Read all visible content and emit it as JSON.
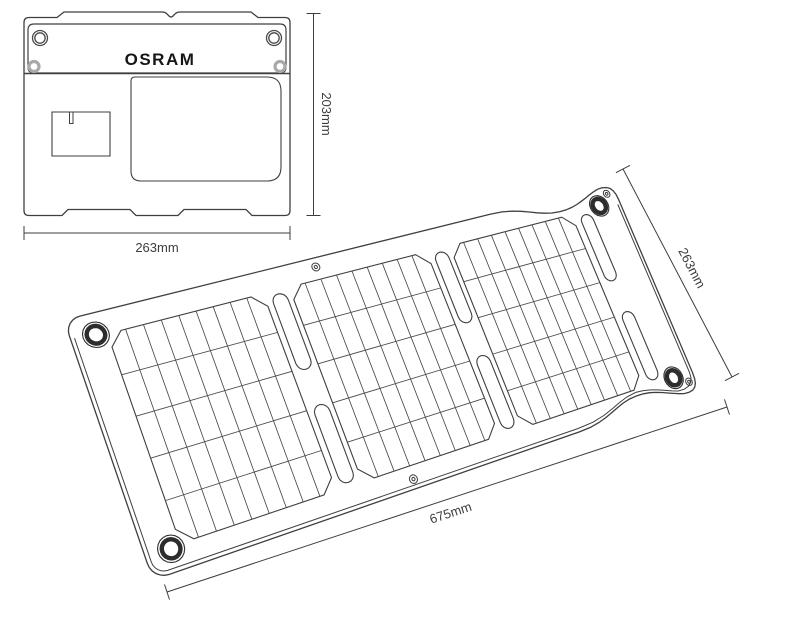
{
  "diagram": {
    "brand": "OSRAM",
    "views": {
      "folded": {
        "width_label": "263mm",
        "height_label": "203mm"
      },
      "unfolded": {
        "width_label": "675mm",
        "height_label": "263mm"
      }
    },
    "icons": {
      "corner_grommet": "grommet-ring-icon",
      "rivet": "rivet-icon",
      "eyelet": "eyelet-icon"
    },
    "colors": {
      "background": "#ffffff",
      "line": "#3f3f3f",
      "grid_line": "#4a4a4a",
      "grommet": "#2d2d2d",
      "gray_ring": "#a9a9a9",
      "text": "#3d3d3d"
    }
  }
}
